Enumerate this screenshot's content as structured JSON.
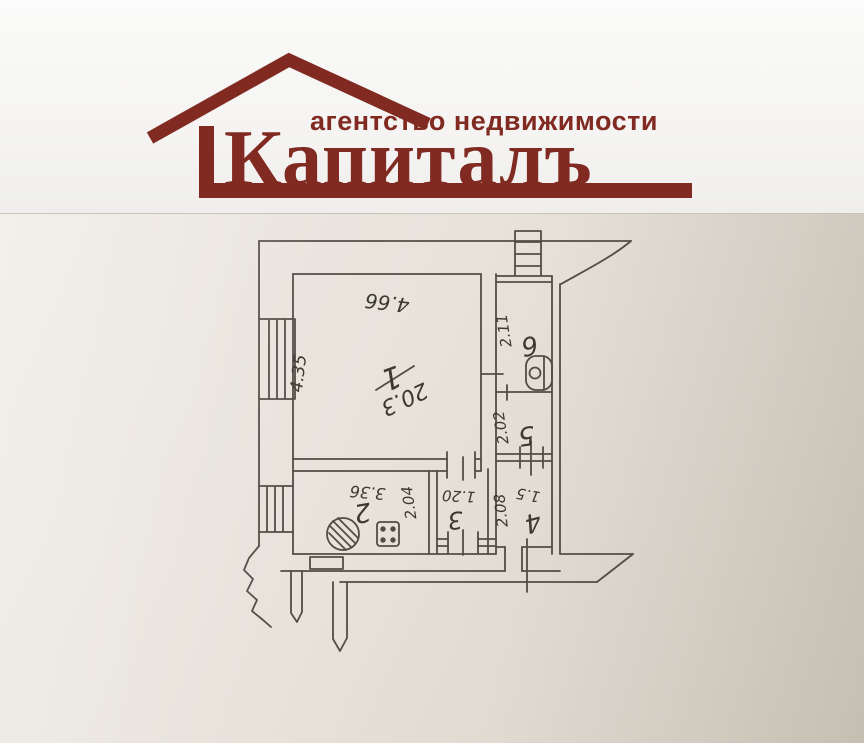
{
  "header": {
    "tagline": "агентство недвижимости",
    "brand": "Капиталъ"
  },
  "colors": {
    "brand_maroon": "#802a22",
    "plan_ink": "#45413a",
    "paper_light": "#eeeae4",
    "paper_dark": "#d6d0c5"
  },
  "floorplan": {
    "type": "apartment-plan",
    "rooms": [
      {
        "number": "1",
        "area": "20.3",
        "width": "4.66",
        "depth": "4.35"
      },
      {
        "number": "2",
        "width": "3.36",
        "depth": "2.04"
      },
      {
        "number": "3",
        "width": "1.20"
      },
      {
        "number": "4",
        "depth": "2.08",
        "width": "1.5"
      },
      {
        "number": "5",
        "depth": "2.02"
      },
      {
        "number": "6",
        "depth": "2.11"
      }
    ],
    "labels": {
      "dim_top": "4.66",
      "dim_left": "4.35",
      "r1_num": "1",
      "r1_area": "20.3",
      "r2_num": "2",
      "r2_dim_a": "3.36",
      "r2_dim_b": "2.04",
      "r3_num": "3",
      "r3_dim": "1.20",
      "r4_num": "4",
      "r4_dim_a": "2.08",
      "r4_dim_b": "1.5",
      "r5_num": "5",
      "r5_dim": "2.02",
      "r6_num": "6",
      "r6_dim": "2.11"
    }
  }
}
